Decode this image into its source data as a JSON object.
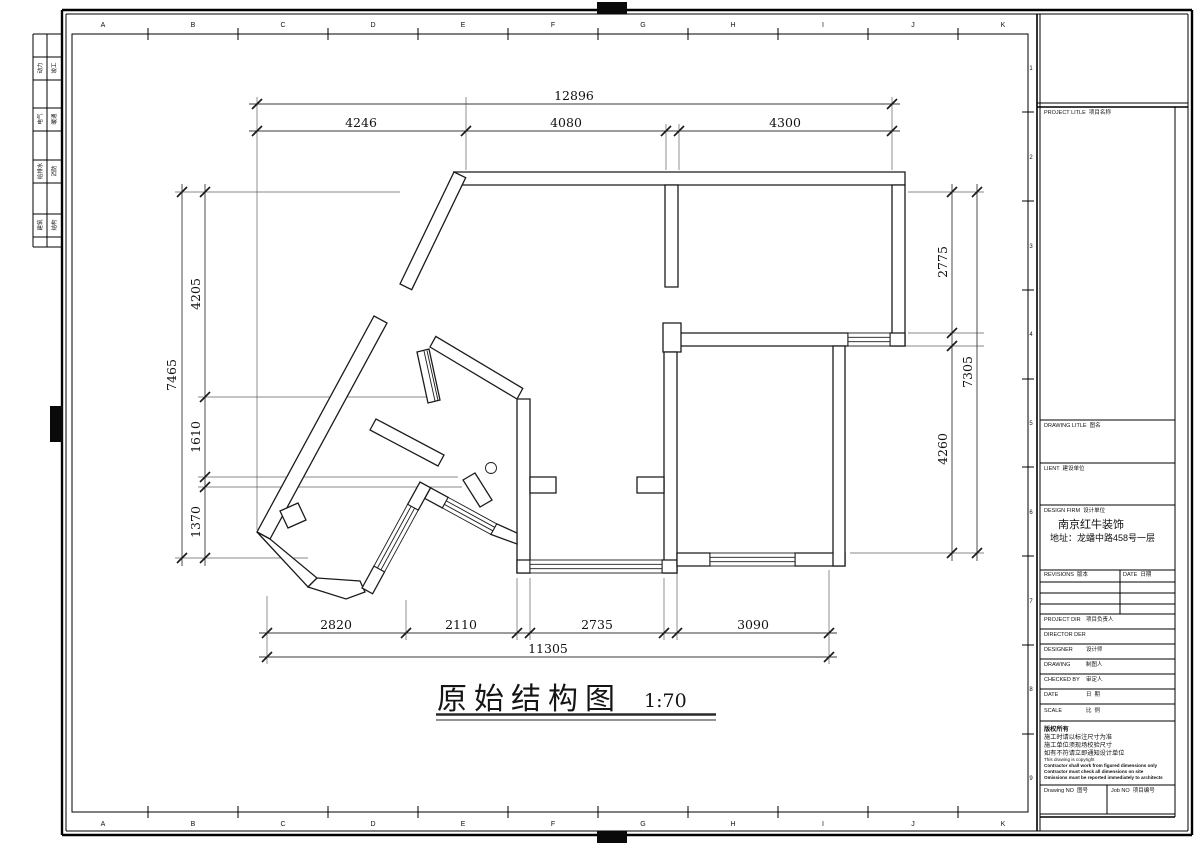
{
  "colors": {
    "paper": "#ffffff",
    "ink": "#1b1b1b"
  },
  "sheet": {
    "plan_title": "原始结构图",
    "plan_scale": "1:70",
    "frame": {
      "col_letters": [
        "A",
        "B",
        "C",
        "D",
        "E",
        "F",
        "G",
        "H",
        "I",
        "J",
        "K"
      ],
      "row_numbers": [
        "1",
        "2",
        "3",
        "4",
        "5",
        "6",
        "7",
        "8",
        "9"
      ],
      "discipline_tabs": [
        {
          "a": "动力",
          "b": "竣工"
        },
        {
          "a": "电气",
          "b": "暖通"
        },
        {
          "a": "给排水",
          "b": "消防"
        },
        {
          "a": "建筑",
          "b": "结构"
        }
      ]
    },
    "dims": {
      "top": {
        "total": "12896",
        "seg1": "4246",
        "seg2": "4080",
        "seg3": "4300"
      },
      "bottom": {
        "total": "11305",
        "seg1": "2820",
        "seg2": "2110",
        "seg3": "2735",
        "seg4": "3090"
      },
      "left": {
        "total": "7465",
        "seg1": "4205",
        "seg2": "1610",
        "seg3": "1370"
      },
      "right": {
        "total": "7305",
        "seg1": "2775",
        "seg2": "4260"
      }
    },
    "title_block": {
      "project_title": "PROJECT LITLE  项目名称",
      "drawing_title": "DRAWING LITLE  图名",
      "client": "LIENT  建设单位",
      "design_firm": "DESIGN FIRM  设计单位",
      "firm_name": "南京红牛装饰",
      "firm_address": "地址：龙蟠中路458号一层",
      "revisions": "REVISIONS  版本",
      "date_col": "DATE  日期",
      "rows": [
        {
          "en": "PROJECT DIR",
          "cn": "项目负责人"
        },
        {
          "en": "DIRECTOR DER",
          "cn": ""
        },
        {
          "en": "DESIGNER",
          "cn": "设计师"
        },
        {
          "en": "DRAWING",
          "cn": "制图人"
        },
        {
          "en": "CHECKED BY",
          "cn": "审定人"
        },
        {
          "en": "DATE",
          "cn": "日  期"
        },
        {
          "en": "SCALE",
          "cn": "比  例"
        }
      ],
      "note1": "版权所有",
      "note2": "施工时请以标注尺寸为准",
      "note3": "施工单位须现场校验尺寸",
      "note4": "如有不符请立即通知设计单位",
      "note5": "This drawing is copyright",
      "note6": "Contractor shall work from figured dimensions only",
      "note7": "Contractor must check all dimensions on site",
      "note8": "Omissions must be reported immediately to architects",
      "drawing_no": "Drawing NO  图号",
      "job_no": "Job NO  项目编号"
    }
  }
}
